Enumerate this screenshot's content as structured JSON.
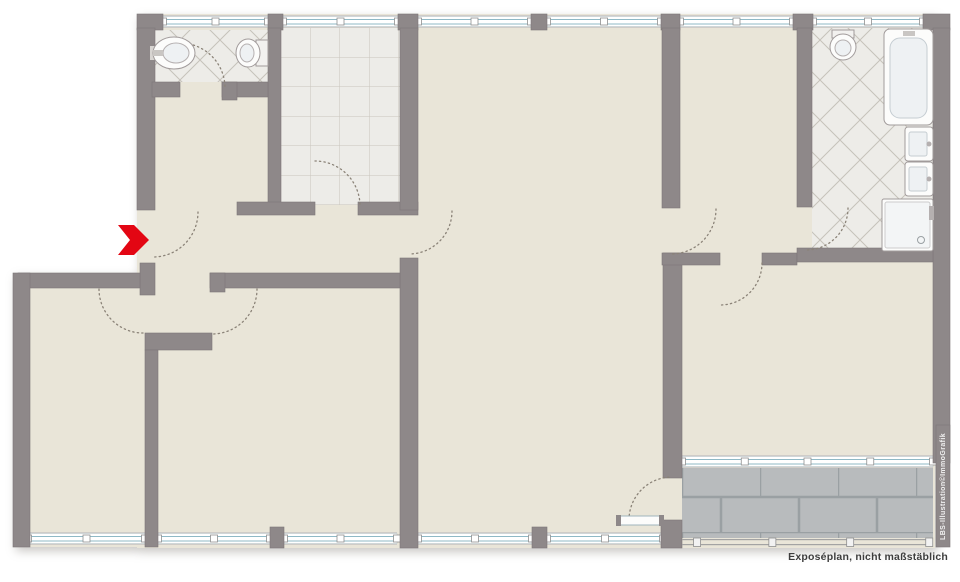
{
  "page": {
    "caption": "Exposéplan, nicht maßstäblich",
    "watermark": "LBS-Illustration©ImmoGrafik"
  },
  "colors": {
    "wall": "#8e8889",
    "wall_edge": "#7d7778",
    "floor": "#e9e5d8",
    "window_underlay": "#cfccc8",
    "window_glass": "#ffffff",
    "window_line": "#8fb9c6",
    "mullion_stroke": "#8f8f8f",
    "railing_line": "#a3a3a3",
    "arc": "#8b8378",
    "fixture_stroke": "#a19b9b",
    "fixture_fill": "#fcfcfb",
    "fixture_inner": "#eef1f3",
    "metal": "#b5b0b0",
    "arrow_red": "#e30613",
    "caption_color": "#3d3d3d"
  },
  "plan": {
    "canvas": {
      "w": 960,
      "h": 582
    },
    "floors": [
      {
        "name": "main-floor",
        "x": 137,
        "y": 14,
        "w": 798,
        "h": 534,
        "fill": "floor"
      },
      {
        "name": "left-wing-floor",
        "x": 13,
        "y": 273,
        "w": 124,
        "h": 274,
        "fill": "floor"
      },
      {
        "name": "wc-tile-floor",
        "x": 152,
        "y": 30,
        "w": 116,
        "h": 52,
        "fill": "diag"
      },
      {
        "name": "kitchen-tile-floor",
        "x": 281,
        "y": 28,
        "w": 119,
        "h": 177,
        "fill": "grid"
      },
      {
        "name": "bath-tile-floor",
        "x": 812,
        "y": 28,
        "w": 121,
        "h": 220,
        "fill": "diag"
      },
      {
        "name": "terrace-tile-floor",
        "x": 682,
        "y": 462,
        "w": 251,
        "h": 76,
        "fill": "terrace"
      }
    ],
    "windows": [
      {
        "name": "wc-window",
        "x": 163,
        "y": 15,
        "w": 105,
        "mullions": [
          0,
          0.5,
          1
        ]
      },
      {
        "name": "kitchen-window",
        "x": 283,
        "y": 15,
        "w": 115,
        "mullions": [
          0,
          0.5,
          1
        ]
      },
      {
        "name": "living-north-window-west",
        "x": 418,
        "y": 15,
        "w": 113,
        "mullions": [
          0,
          0.5,
          1
        ]
      },
      {
        "name": "living-north-window-east",
        "x": 547,
        "y": 15,
        "w": 114,
        "mullions": [
          0,
          0.5,
          1
        ]
      },
      {
        "name": "middleroom-window",
        "x": 680,
        "y": 15,
        "w": 113,
        "mullions": [
          0,
          0.5,
          1
        ]
      },
      {
        "name": "bath-window",
        "x": 813,
        "y": 15,
        "w": 110,
        "mullions": [
          0,
          0.5,
          1
        ]
      },
      {
        "name": "bedroom-left-window",
        "x": 28,
        "y": 532,
        "w": 117,
        "mullions": [
          0,
          0.5,
          1
        ]
      },
      {
        "name": "bedroom2-window-west",
        "x": 158,
        "y": 532,
        "w": 112,
        "mullions": [
          0,
          0.5,
          1
        ]
      },
      {
        "name": "bedroom2-window-east",
        "x": 284,
        "y": 532,
        "w": 113,
        "mullions": [
          0,
          0.5,
          1
        ]
      },
      {
        "name": "living-south-window-west",
        "x": 418,
        "y": 532,
        "w": 114,
        "mullions": [
          0,
          0.5,
          1
        ]
      },
      {
        "name": "living-south-window-east",
        "x": 547,
        "y": 532,
        "w": 116,
        "mullions": [
          0,
          0.5,
          1
        ]
      },
      {
        "name": "bedroom-terrace-window",
        "x": 682,
        "y": 455,
        "w": 251,
        "mullions": [
          0,
          0.25,
          0.5,
          0.75,
          1
        ]
      }
    ],
    "railing": {
      "name": "terrace-railing",
      "x": 682,
      "y": 538,
      "w": 251,
      "posts": [
        0.06,
        0.36,
        0.67,
        0.985
      ]
    },
    "walls": [
      {
        "name": "top-left-corner-pier",
        "x": 137,
        "y": 14,
        "w": 26,
        "h": 16
      },
      {
        "name": "kitchen-wall-head-pier",
        "x": 268,
        "y": 14,
        "w": 15,
        "h": 16
      },
      {
        "name": "living-west-head-pier",
        "x": 398,
        "y": 14,
        "w": 20,
        "h": 16
      },
      {
        "name": "living-window-mid-pier",
        "x": 531,
        "y": 14,
        "w": 16,
        "h": 16
      },
      {
        "name": "middleroom-west-head-pier",
        "x": 661,
        "y": 14,
        "w": 19,
        "h": 16
      },
      {
        "name": "bath-west-head-pier",
        "x": 793,
        "y": 14,
        "w": 20,
        "h": 16
      },
      {
        "name": "top-right-corner-pier",
        "x": 923,
        "y": 14,
        "w": 27,
        "h": 16
      },
      {
        "name": "left-upper-exterior-wall",
        "x": 137,
        "y": 28,
        "w": 18,
        "h": 182
      },
      {
        "name": "entrance-south-jamb",
        "x": 140,
        "y": 263,
        "w": 15,
        "h": 32
      },
      {
        "name": "hall-west-wall",
        "x": 18,
        "y": 273,
        "w": 122,
        "h": 15
      },
      {
        "name": "left-lower-exterior-wall",
        "x": 13,
        "y": 273,
        "w": 17,
        "h": 274
      },
      {
        "name": "right-exterior-wall",
        "x": 933,
        "y": 28,
        "w": 17,
        "h": 435
      },
      {
        "name": "kitchen-west-wall",
        "x": 268,
        "y": 28,
        "w": 13,
        "h": 185
      },
      {
        "name": "wc-south-wall-west",
        "x": 152,
        "y": 82,
        "w": 28,
        "h": 15
      },
      {
        "name": "wc-south-wall-east",
        "x": 222,
        "y": 82,
        "w": 46,
        "h": 15
      },
      {
        "name": "wc-door-jamb",
        "x": 222,
        "y": 82,
        "w": 15,
        "h": 18
      },
      {
        "name": "hall-north-wall-west",
        "x": 237,
        "y": 202,
        "w": 78,
        "h": 13
      },
      {
        "name": "hall-north-wall-east",
        "x": 358,
        "y": 202,
        "w": 60,
        "h": 13
      },
      {
        "name": "living-west-wall-upper",
        "x": 400,
        "y": 28,
        "w": 18,
        "h": 182
      },
      {
        "name": "living-west-wall-lower",
        "x": 400,
        "y": 258,
        "w": 18,
        "h": 290
      },
      {
        "name": "hall-south-wall",
        "x": 210,
        "y": 273,
        "w": 190,
        "h": 15
      },
      {
        "name": "hall-south-jamb",
        "x": 210,
        "y": 273,
        "w": 15,
        "h": 19
      },
      {
        "name": "vestibule-south-wall",
        "x": 145,
        "y": 333,
        "w": 67,
        "h": 17
      },
      {
        "name": "bedrooms-divider-wall",
        "x": 145,
        "y": 350,
        "w": 13,
        "h": 197
      },
      {
        "name": "bl2-window-pier",
        "x": 270,
        "y": 527,
        "w": 14,
        "h": 21
      },
      {
        "name": "living-window-mid-pier-bottom",
        "x": 532,
        "y": 527,
        "w": 15,
        "h": 21
      },
      {
        "name": "terrace-corner-wall",
        "x": 661,
        "y": 520,
        "w": 21,
        "h": 28
      },
      {
        "name": "middleroom-west-wall",
        "x": 662,
        "y": 28,
        "w": 18,
        "h": 180
      },
      {
        "name": "bedroom-west-wall",
        "x": 663,
        "y": 253,
        "w": 19,
        "h": 225
      },
      {
        "name": "bedroom-north-wall-west",
        "x": 662,
        "y": 253,
        "w": 58,
        "h": 12
      },
      {
        "name": "bedroom-north-wall-east",
        "x": 762,
        "y": 253,
        "w": 35,
        "h": 12
      },
      {
        "name": "bath-south-wall",
        "x": 797,
        "y": 248,
        "w": 136,
        "h": 14
      },
      {
        "name": "bath-west-wall",
        "x": 797,
        "y": 28,
        "w": 15,
        "h": 179
      },
      {
        "name": "watermark-strip",
        "x": 936,
        "y": 425,
        "w": 14,
        "h": 122
      }
    ],
    "arcs": [
      {
        "name": "wc-door-swing",
        "cx": 180,
        "cy": 88,
        "r": 45,
        "a1": -90,
        "a2": 0
      },
      {
        "name": "kitchen-door-swing",
        "cx": 315,
        "cy": 206,
        "r": 45,
        "a1": -90,
        "a2": 0
      },
      {
        "name": "entrance-door-swing",
        "cx": 153,
        "cy": 212,
        "r": 45,
        "a1": 0,
        "a2": 90
      },
      {
        "name": "living-door-swing",
        "cx": 409,
        "cy": 211,
        "r": 43,
        "a1": 0,
        "a2": 90
      },
      {
        "name": "bedroom-left-door-swing",
        "cx": 143,
        "cy": 289,
        "r": 44,
        "a1": 90,
        "a2": 180
      },
      {
        "name": "bedroom2-door-swing",
        "cx": 212,
        "cy": 289,
        "r": 45,
        "a1": 0,
        "a2": 90
      },
      {
        "name": "middleroom-door-swing",
        "cx": 671,
        "cy": 209,
        "r": 45,
        "a1": 0,
        "a2": 90
      },
      {
        "name": "bedroom-right-door-swing",
        "cx": 720,
        "cy": 263,
        "r": 42,
        "a1": 0,
        "a2": 90
      },
      {
        "name": "bath-door-swing",
        "cx": 806,
        "cy": 208,
        "r": 42,
        "a1": 0,
        "a2": 90
      },
      {
        "name": "terrace-door-swing",
        "cx": 672,
        "cy": 520,
        "r": 43,
        "a1": 180,
        "a2": 270
      }
    ],
    "fixtures": [
      {
        "name": "wc-sink",
        "shapes": [
          {
            "t": "rect",
            "x": 150,
            "y": 46,
            "w": 8,
            "h": 14,
            "f": "#d8d5d2"
          },
          {
            "t": "ellipse",
            "cx": 174,
            "cy": 53,
            "rx": 21,
            "ry": 16,
            "f": "#fcfcfb",
            "s": "#a19b9b"
          },
          {
            "t": "ellipse",
            "cx": 176,
            "cy": 53,
            "rx": 13,
            "ry": 10,
            "f": "#eef1f3",
            "s": "#b5b0b0"
          },
          {
            "t": "rect",
            "x": 153,
            "y": 50,
            "w": 10,
            "h": 6,
            "f": "#c9c6c3"
          }
        ]
      },
      {
        "name": "wc-toilet",
        "shapes": [
          {
            "t": "rect",
            "x": 256,
            "y": 40,
            "w": 12,
            "h": 26,
            "f": "#f2f1ef",
            "s": "#a19b9b"
          },
          {
            "t": "ellipse",
            "cx": 248,
            "cy": 53,
            "rx": 12,
            "ry": 14,
            "f": "#fcfcfb",
            "s": "#a19b9b"
          },
          {
            "t": "ellipse",
            "cx": 247,
            "cy": 53,
            "rx": 7,
            "ry": 9,
            "f": "#eef1f3",
            "s": "#b5b0b0"
          }
        ]
      },
      {
        "name": "bath-toilet",
        "shapes": [
          {
            "t": "rect",
            "x": 832,
            "y": 30,
            "w": 22,
            "h": 8,
            "f": "#f2f1ef",
            "s": "#a19b9b"
          },
          {
            "t": "ellipse",
            "cx": 843,
            "cy": 47,
            "rx": 13,
            "ry": 13,
            "f": "#fcfcfb",
            "s": "#a19b9b"
          },
          {
            "t": "ellipse",
            "cx": 843,
            "cy": 48,
            "rx": 8,
            "ry": 8,
            "f": "#eef1f3",
            "s": "#b5b0b0"
          }
        ]
      },
      {
        "name": "bathtub",
        "shapes": [
          {
            "t": "rect",
            "x": 884,
            "y": 29,
            "w": 49,
            "h": 96,
            "rx": 6,
            "f": "#fcfcfb",
            "s": "#a19b9b"
          },
          {
            "t": "rect",
            "x": 890,
            "y": 38,
            "w": 37,
            "h": 80,
            "rx": 10,
            "f": "#eef1f3",
            "s": "#c5cdd2"
          },
          {
            "t": "rect",
            "x": 903,
            "y": 31,
            "w": 12,
            "h": 5,
            "f": "#c9c6c3"
          }
        ]
      },
      {
        "name": "bath-sink-1",
        "shapes": [
          {
            "t": "rect",
            "x": 905,
            "y": 127,
            "w": 28,
            "h": 34,
            "rx": 3,
            "f": "#fcfcfb",
            "s": "#a19b9b"
          },
          {
            "t": "rect",
            "x": 909,
            "y": 132,
            "w": 18,
            "h": 24,
            "rx": 2,
            "f": "#eef1f3",
            "s": "#c5cdd2"
          },
          {
            "t": "circle",
            "cx": 929,
            "cy": 144,
            "r": 2.5,
            "f": "#b5b0b0"
          }
        ]
      },
      {
        "name": "bath-sink-2",
        "shapes": [
          {
            "t": "rect",
            "x": 905,
            "y": 162,
            "w": 28,
            "h": 34,
            "rx": 3,
            "f": "#fcfcfb",
            "s": "#a19b9b"
          },
          {
            "t": "rect",
            "x": 909,
            "y": 167,
            "w": 18,
            "h": 24,
            "rx": 2,
            "f": "#eef1f3",
            "s": "#c5cdd2"
          },
          {
            "t": "circle",
            "cx": 929,
            "cy": 179,
            "r": 2.5,
            "f": "#b5b0b0"
          }
        ]
      },
      {
        "name": "shower",
        "shapes": [
          {
            "t": "rect",
            "x": 882,
            "y": 199,
            "w": 51,
            "h": 52,
            "rx": 2,
            "f": "#fcfcfb",
            "s": "#a19b9b"
          },
          {
            "t": "rect",
            "x": 885,
            "y": 202,
            "w": 45,
            "h": 46,
            "rx": 2,
            "f": "#f3f5f6",
            "s": "#cccccc"
          },
          {
            "t": "circle",
            "cx": 921,
            "cy": 240,
            "r": 3.5,
            "f": "none",
            "s": "#9aa0a3"
          },
          {
            "t": "rect",
            "x": 929,
            "y": 206,
            "w": 5,
            "h": 14,
            "f": "#b5b0b0"
          }
        ]
      },
      {
        "name": "terrace-door-leaf",
        "shapes": [
          {
            "t": "rect",
            "x": 618,
            "y": 516,
            "w": 45,
            "h": 9,
            "f": "#fcfcfb",
            "s": "#9fb5bd"
          },
          {
            "t": "rect",
            "x": 616,
            "y": 515,
            "w": 5,
            "h": 11,
            "f": "#8e8889"
          },
          {
            "t": "rect",
            "x": 659,
            "y": 515,
            "w": 5,
            "h": 11,
            "f": "#8e8889"
          }
        ]
      }
    ],
    "entrance_arrow": {
      "name": "entrance-arrow",
      "points": "118,225 134,225 149,240 134,255 118,255 130,240"
    }
  }
}
